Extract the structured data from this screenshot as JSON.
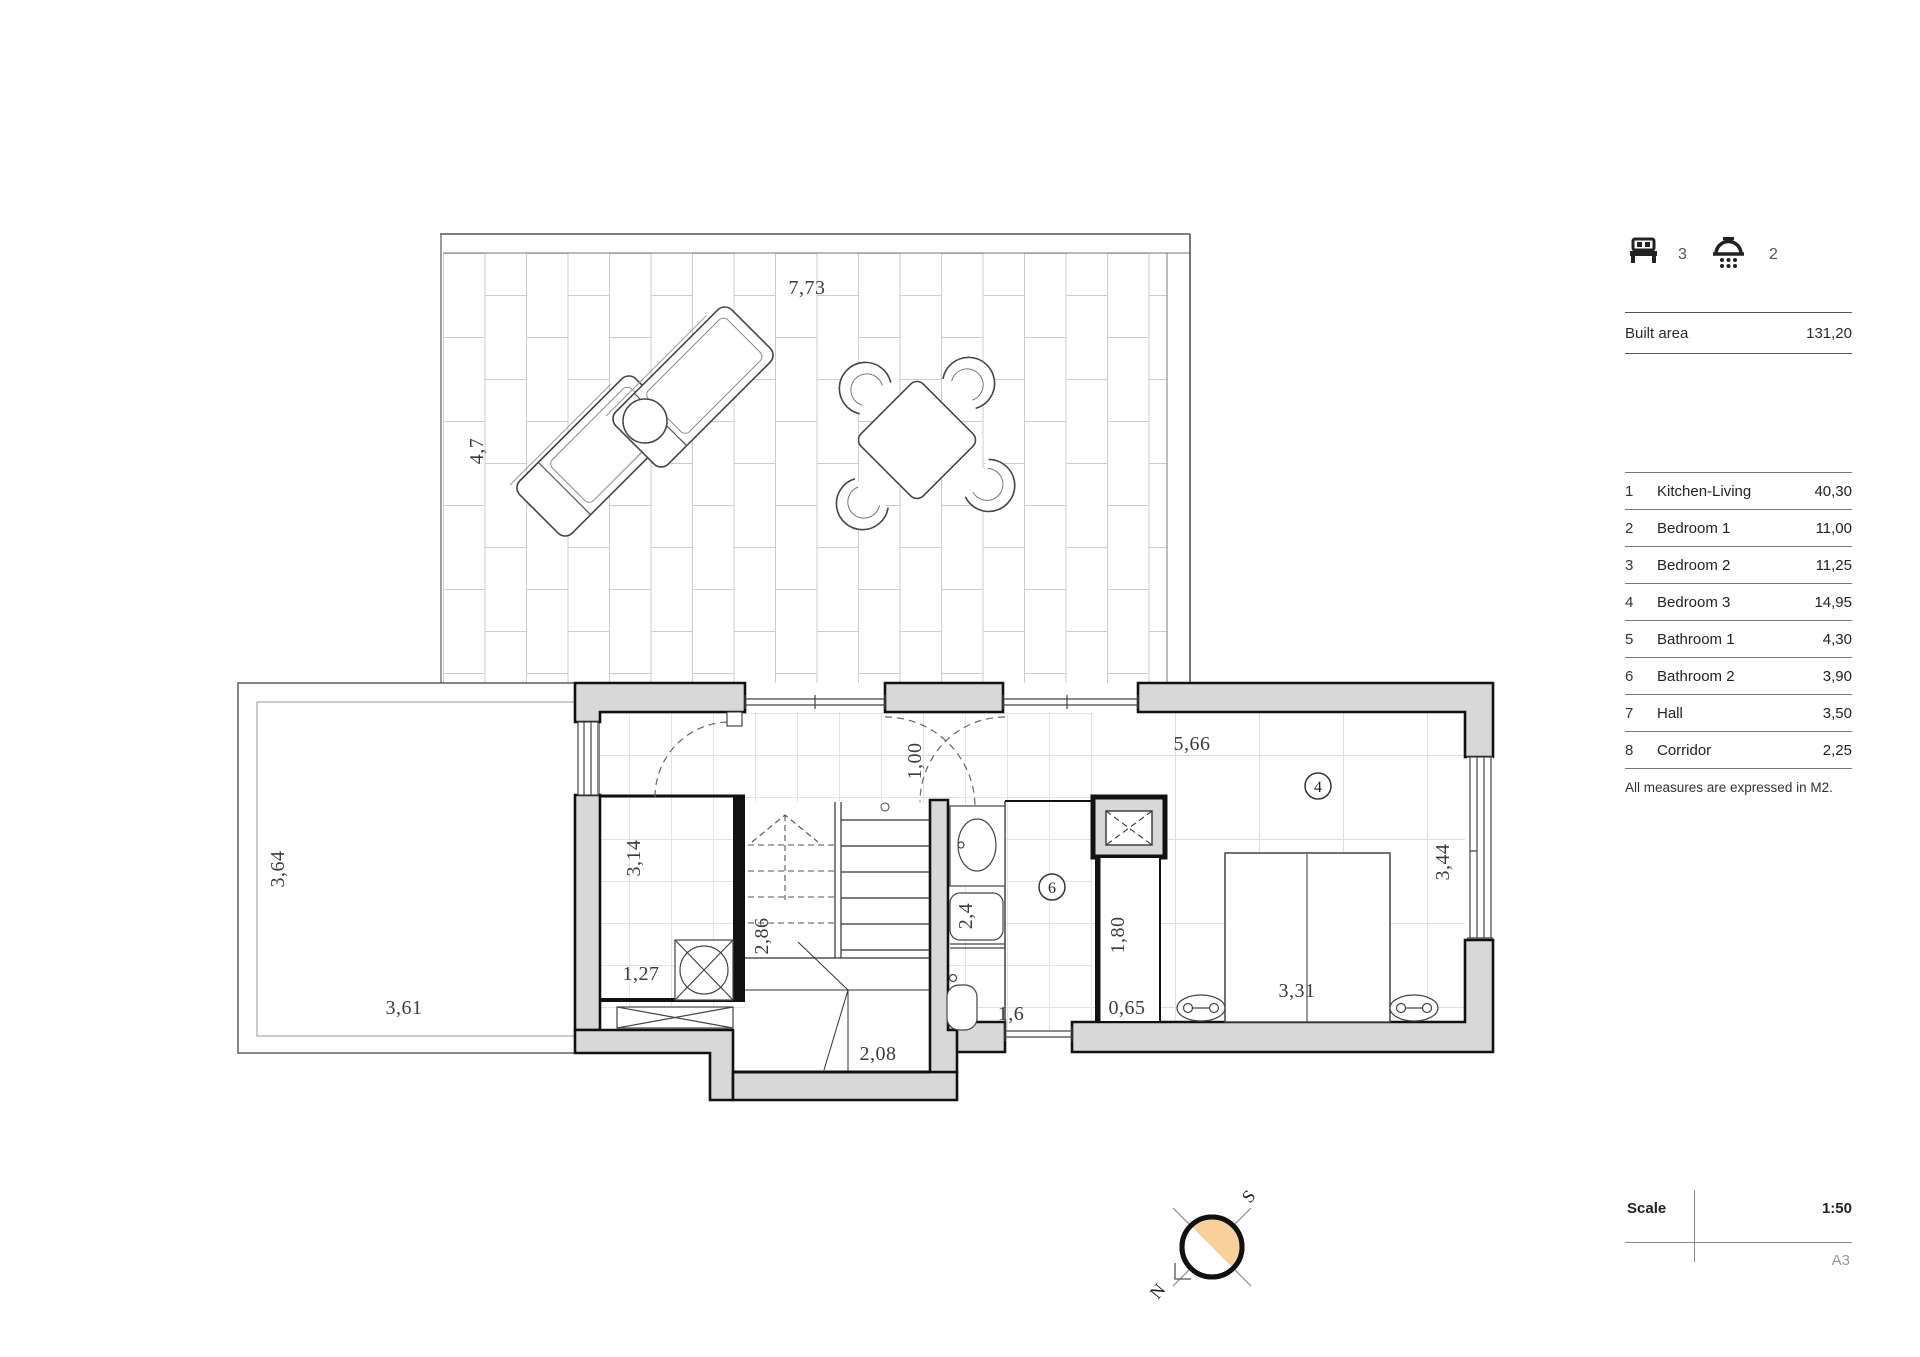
{
  "legend": {
    "beds_count": "3",
    "showers_count": "2",
    "built_area": {
      "label": "Built area",
      "value": "131,20"
    },
    "rooms": [
      {
        "num": "1",
        "name": "Kitchen-Living",
        "area": "40,30"
      },
      {
        "num": "2",
        "name": "Bedroom 1",
        "area": "11,00"
      },
      {
        "num": "3",
        "name": "Bedroom 2",
        "area": "11,25"
      },
      {
        "num": "4",
        "name": "Bedroom 3",
        "area": "14,95"
      },
      {
        "num": "5",
        "name": "Bathroom 1",
        "area": "4,30"
      },
      {
        "num": "6",
        "name": "Bathroom 2",
        "area": "3,90"
      },
      {
        "num": "7",
        "name": "Hall",
        "area": "3,50"
      },
      {
        "num": "8",
        "name": "Corridor",
        "area": "2,25"
      }
    ],
    "note": "All measures are expressed in M2.",
    "scale": {
      "label": "Scale",
      "value": "1:50",
      "sheet": "A3"
    }
  },
  "plan": {
    "dims": {
      "terrace_width": "7,73",
      "terrace_depth": "4,7",
      "side_terrace_depth": "3,64",
      "side_terrace_width": "3,61",
      "storage_depth": "3,14",
      "storage_width": "1,27",
      "stair_flight": "2,86",
      "stair_landing": "2,08",
      "hall_door": "1,00",
      "bedroom_width": "5,66",
      "bedroom_depth": "3,44",
      "bed_width": "3,31",
      "wardrobe_length": "1,80",
      "wardrobe_depth": "0,65",
      "bathroom_width": "1,6",
      "bath_fixture": "2,4"
    },
    "tags": {
      "bedroom3": "4",
      "bathroom2": "6"
    },
    "compass": {
      "north": "N",
      "south": "S"
    }
  },
  "colors": {
    "wall_fill": "#d8d8d8",
    "line_dark": "#111111",
    "grid_line": "#e0e0e0",
    "tile_line": "#cccccc",
    "compass_accent": "#f7d09b"
  }
}
